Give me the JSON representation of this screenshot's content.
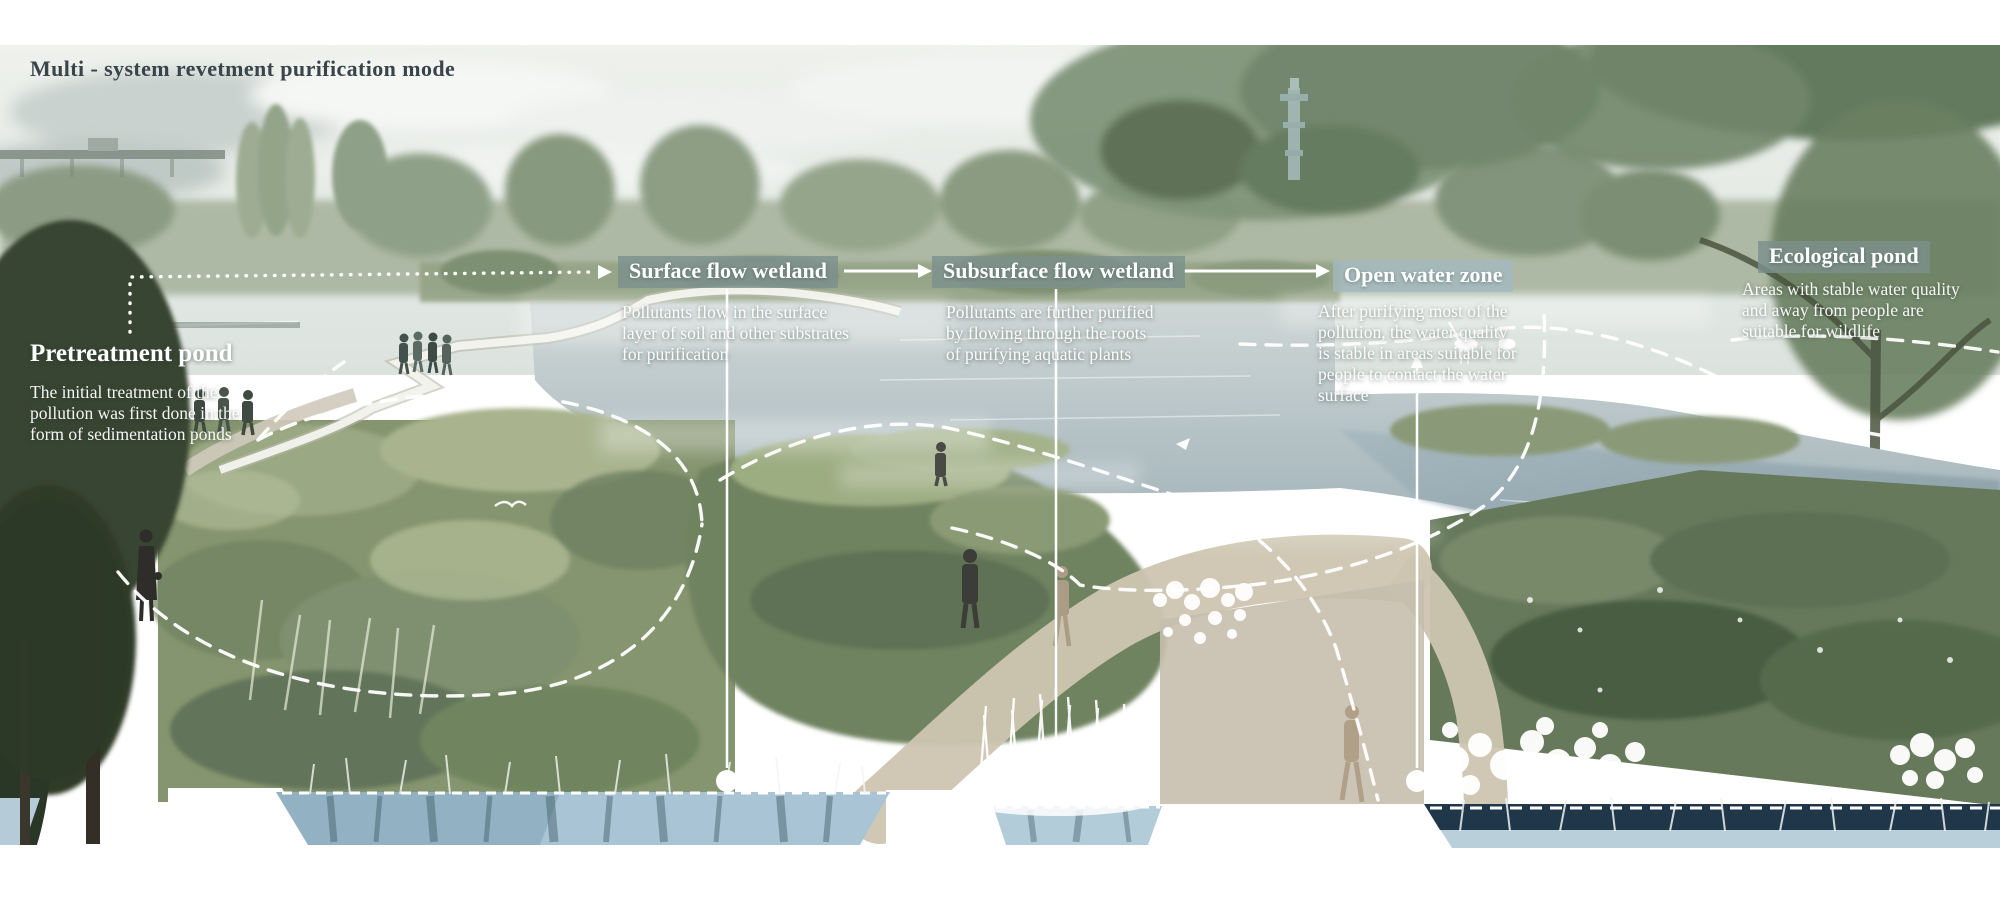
{
  "title": "Multi - system revetment purification mode",
  "zones": [
    {
      "id": "pretreatment-pond",
      "label": "Pretreatment pond",
      "description": "The initial treatment of the\npollution was first done in the\nform of sedimentation ponds",
      "label_style": "plain"
    },
    {
      "id": "surface-flow-wetland",
      "label": "Surface flow wetland",
      "description": "Pollutants flow in the surface\nlayer of soil and other substrates\nfor purification",
      "label_style": "box-green"
    },
    {
      "id": "subsurface-flow-wetland",
      "label": "Subsurface flow wetland",
      "description": "Pollutants are further purified\nby flowing through the roots\nof purifying aquatic plants",
      "label_style": "box-green"
    },
    {
      "id": "open-water-zone",
      "label": "Open water zone",
      "description": "After purifying most of the\npollution, the water quality\nis stable in areas suitable for\npeople to contact the water\nsurface",
      "label_style": "box-blue"
    },
    {
      "id": "ecological-pond",
      "label": "Ecological pond",
      "description": "Areas with stable water quality\nand away from people are\nsuitable for wildlife",
      "label_style": "box-green"
    }
  ],
  "colors": {
    "title_text": "#3a444b",
    "zone_label_text": "#ffffff",
    "label_box_green": "#7d908f",
    "label_box_blue": "#a3b8c0",
    "annotation_white": "#ffffff",
    "water_band_light": "#a9c4d4",
    "water_band_navy": "#203649"
  }
}
